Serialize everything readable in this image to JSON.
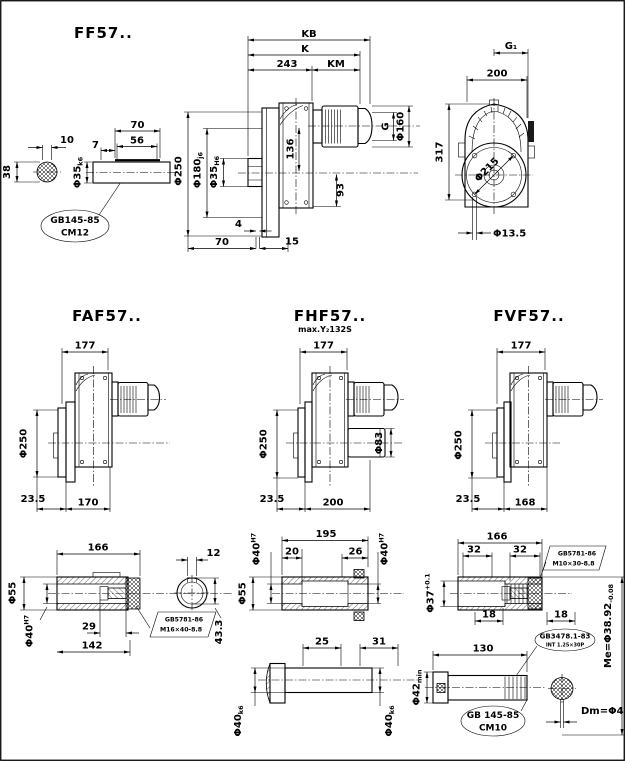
{
  "colors": {
    "ink": "#000000",
    "paper": "#ffffff"
  },
  "views": {
    "ff57": {
      "title": "FF57..",
      "cross_w": "10",
      "cross_h": "38",
      "shaft_len": "70",
      "key_len": "56",
      "key_offset": "7",
      "shaft_dia": "Φ35",
      "shaft_dia_tol": "k6",
      "center_hole_std": "GB145-85",
      "center_hole_type": "CM12",
      "kb": "KB",
      "k": "K",
      "len_243": "243",
      "km": "KM",
      "g": "G",
      "motor_dia": "Φ160",
      "flange_dia": "Φ250",
      "spigot_dia": "Φ180",
      "spigot_tol": "j6",
      "bore_dia": "Φ35",
      "bore_tol": "H6",
      "h_136": "136",
      "h_93": "93",
      "t_4": "4",
      "b_70": "70",
      "b_15": "15",
      "g1": "G₁",
      "front_w": "200",
      "front_h": "317",
      "bolt_circle": "Φ215",
      "hole_dia": "Φ13.5"
    },
    "faf57": {
      "title": "FAF57..",
      "w": "177",
      "flange_dia": "Φ250",
      "b1": "23.5",
      "b2": "170"
    },
    "fhf57": {
      "title": "FHF57..",
      "subtitle": "max.Y₂132S",
      "w": "177",
      "flange_dia": "Φ250",
      "cover_dia": "Φ83",
      "b1": "23.5",
      "b2": "200"
    },
    "fvf57": {
      "title": "FVF57..",
      "w": "177",
      "flange_dia": "Φ250",
      "b1": "23.5",
      "b2": "168"
    },
    "hollow_shaft": {
      "len": "166",
      "od": "Φ55",
      "bore": "Φ40",
      "bore_tol": "H7",
      "l29": "29",
      "l142": "142",
      "bolt_std": "GB5781-86",
      "bolt_size": "M16×40-8.8",
      "key_w": "12",
      "key_h": "43.3"
    },
    "through_shaft": {
      "len": "195",
      "l20": "20",
      "l26": "26",
      "bore": "Φ40",
      "bore_tol": "H7",
      "od": "Φ55",
      "l25": "25",
      "l31": "31",
      "shaft": "Φ40",
      "shaft_tol": "k6"
    },
    "spline_shaft": {
      "len": "166",
      "l32": "32",
      "bolt_std": "GB5781-86",
      "bolt_size": "M10×30-8.8",
      "bore": "Φ37",
      "bore_tol": "+0.1",
      "l18": "18",
      "spline_std": "GB3478.1-83",
      "spline_spec": "INT 1.25×30P",
      "l130": "130",
      "shaft": "Φ42",
      "shaft_tol": "min",
      "center_hole_std": "GB 145-85",
      "center_hole_type": "CM10",
      "me": "Me=Φ38.92",
      "me_tol": "-0.08",
      "dm": "Dm=Φ4"
    }
  }
}
